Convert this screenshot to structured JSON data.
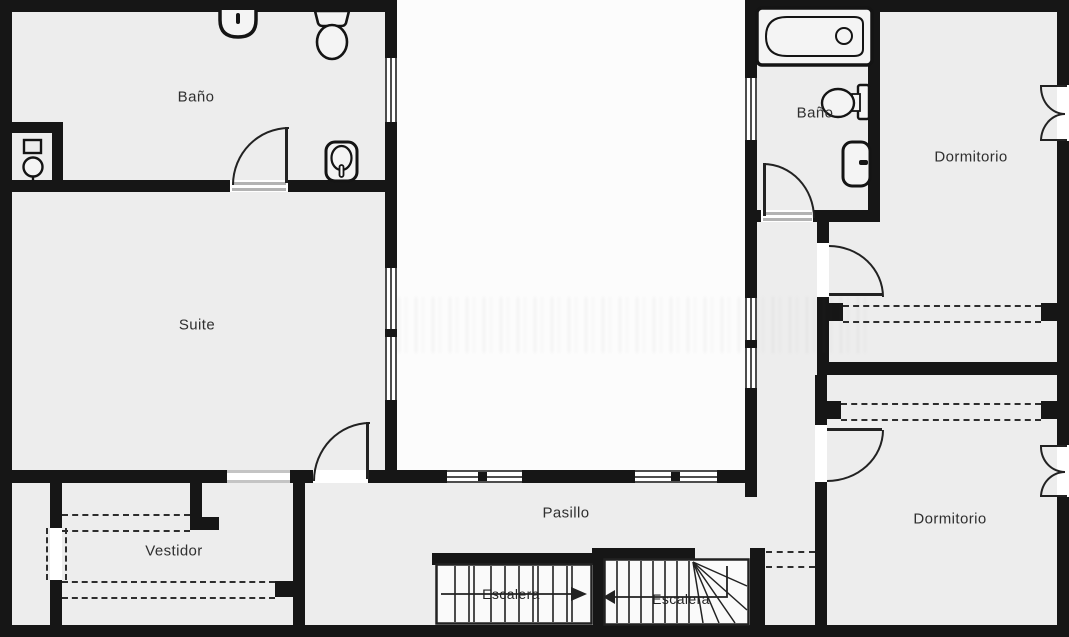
{
  "plan": {
    "type": "floor-plan",
    "language": "es",
    "colors": {
      "wall": "#161616",
      "room_fill": "#ededed",
      "background": "#fcfcfc",
      "line": "#222222",
      "threshold": "#b3b3b3"
    },
    "rooms": [
      {
        "id": "bano-left",
        "label": "Baño",
        "fixtures": [
          "sink-icon",
          "toilet-icon",
          "shower-icon",
          "bidet-icon",
          "door-arc-icon",
          "window-icon"
        ]
      },
      {
        "id": "suite",
        "label": "Suite",
        "fixtures": [
          "window-icon",
          "door-arc-icon",
          "sliding-door-icon"
        ]
      },
      {
        "id": "vestidor",
        "label": "Vestidor",
        "fixtures": [
          "wardrobe-dashed-icon",
          "sliding-door-icon"
        ]
      },
      {
        "id": "pasillo",
        "label": "Pasillo",
        "fixtures": [
          "window-icon"
        ]
      },
      {
        "id": "escalera-left",
        "label": "Escalera",
        "direction": "right",
        "fixtures": [
          "stair-treads-icon",
          "direction-arrow-icon"
        ]
      },
      {
        "id": "escalera-right",
        "label": "Escalera",
        "direction": "left",
        "fixtures": [
          "stair-treads-icon",
          "winder-icon",
          "direction-arrow-icon"
        ]
      },
      {
        "id": "bano-right",
        "label": "Baño",
        "fixtures": [
          "bathtub-icon",
          "toilet-icon",
          "sink-icon",
          "door-arc-icon"
        ]
      },
      {
        "id": "dormitorio-top",
        "label": "Dormitorio",
        "fixtures": [
          "door-arc-icon",
          "wardrobe-dashed-icon",
          "casement-window-icon"
        ]
      },
      {
        "id": "dormitorio-bottom",
        "label": "Dormitorio",
        "fixtures": [
          "door-arc-icon",
          "wardrobe-dashed-icon",
          "casement-window-icon"
        ]
      }
    ]
  }
}
